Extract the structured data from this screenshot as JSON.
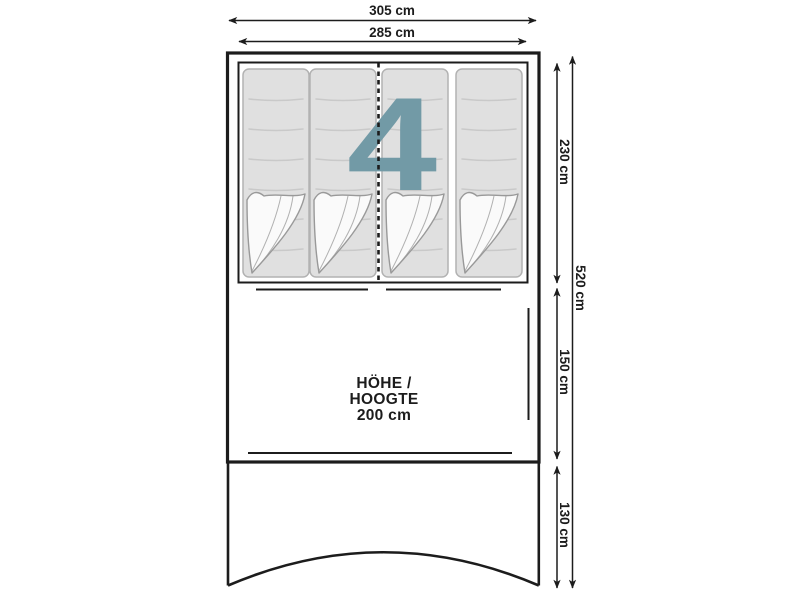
{
  "diagram": {
    "kind": "tent floor plan",
    "capacity": "4",
    "height_note": {
      "line1": "HÖHE /",
      "line2": "HOOGTE",
      "line3": "200 cm"
    },
    "dimensions": {
      "outer_width": "305 cm",
      "inner_width": "285 cm",
      "cabin_depth": "230 cm",
      "living_depth": "150 cm",
      "porch_depth": "130 cm",
      "total_depth": "520 cm"
    },
    "colors": {
      "line": "#1c1c1c",
      "accent": "#729aa6",
      "mat_fill": "#e0e0e0",
      "mat_border": "#b2b2b2",
      "mat_stitch": "#c9c9c9",
      "fold_fill": "#fafafa",
      "fold_line": "#999999"
    }
  }
}
